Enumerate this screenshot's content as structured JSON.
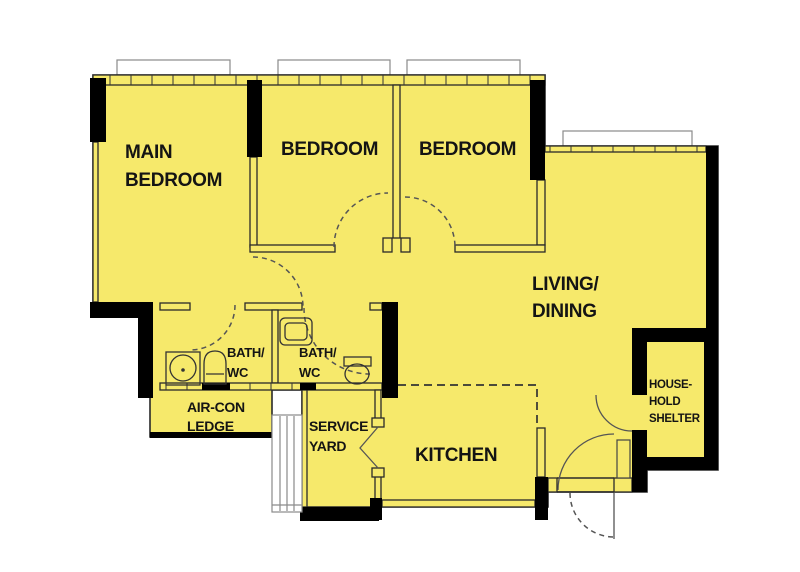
{
  "diagram_type": "apartment-floor-plan",
  "colors": {
    "floor": "#F6E96B",
    "wall": "#000000",
    "outline": "#2A2A2A",
    "dash": "#555555",
    "window_line": "#8a8a8a",
    "background": "#FFFFFF"
  },
  "rooms": {
    "main_bedroom": {
      "line1": "MAIN",
      "line2": "BEDROOM"
    },
    "bedroom_2": {
      "line1": "BEDROOM"
    },
    "bedroom_3": {
      "line1": "BEDROOM"
    },
    "living_dining": {
      "line1": "LIVING/",
      "line2": "DINING"
    },
    "kitchen": {
      "line1": "KITCHEN"
    },
    "bath_wc_1": {
      "line1": "BATH/",
      "line2": "WC"
    },
    "bath_wc_2": {
      "line1": "BATH/",
      "line2": "WC"
    },
    "air_con_ledge": {
      "line1": "AIR-CON",
      "line2": "LEDGE"
    },
    "service_yard": {
      "line1": "SERVICE",
      "line2": "YARD"
    },
    "household_shelter": {
      "line1": "HOUSE-",
      "line2": "HOLD",
      "line3": "SHELTER"
    }
  }
}
